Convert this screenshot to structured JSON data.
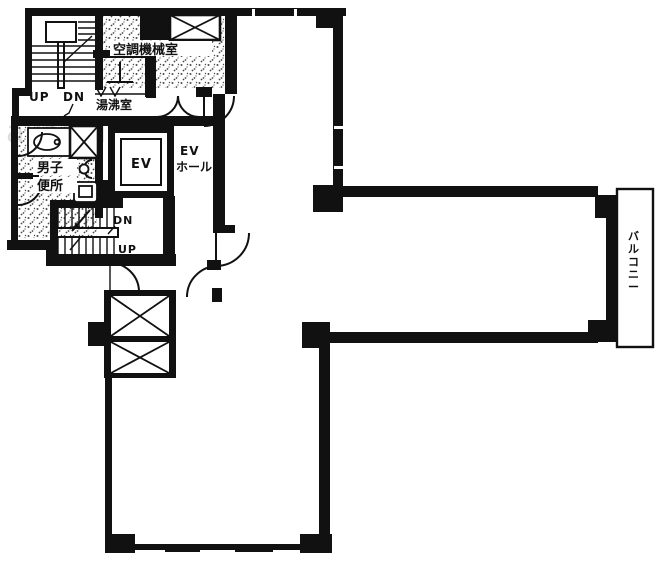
{
  "title": "building-floor-plan",
  "watermark": "akeoffice",
  "labels": {
    "machine_room": "空調機械室",
    "hot_water_room": "湯沸室",
    "mens_toilet_line1": "男子",
    "mens_toilet_line2": "便所",
    "elevator": "EV",
    "ev_hall_line1": "EV",
    "ev_hall_line2": "ホール",
    "balcony": "バルコニー",
    "stair_upper_up": "UP",
    "stair_upper_dn": "DN",
    "stair_lower_dn": "DN",
    "stair_lower_up": "UP"
  },
  "colors": {
    "wall": "#111111",
    "background": "#ffffff",
    "stipple": "#4a4a4a",
    "watermark": "#d9d9d9"
  }
}
